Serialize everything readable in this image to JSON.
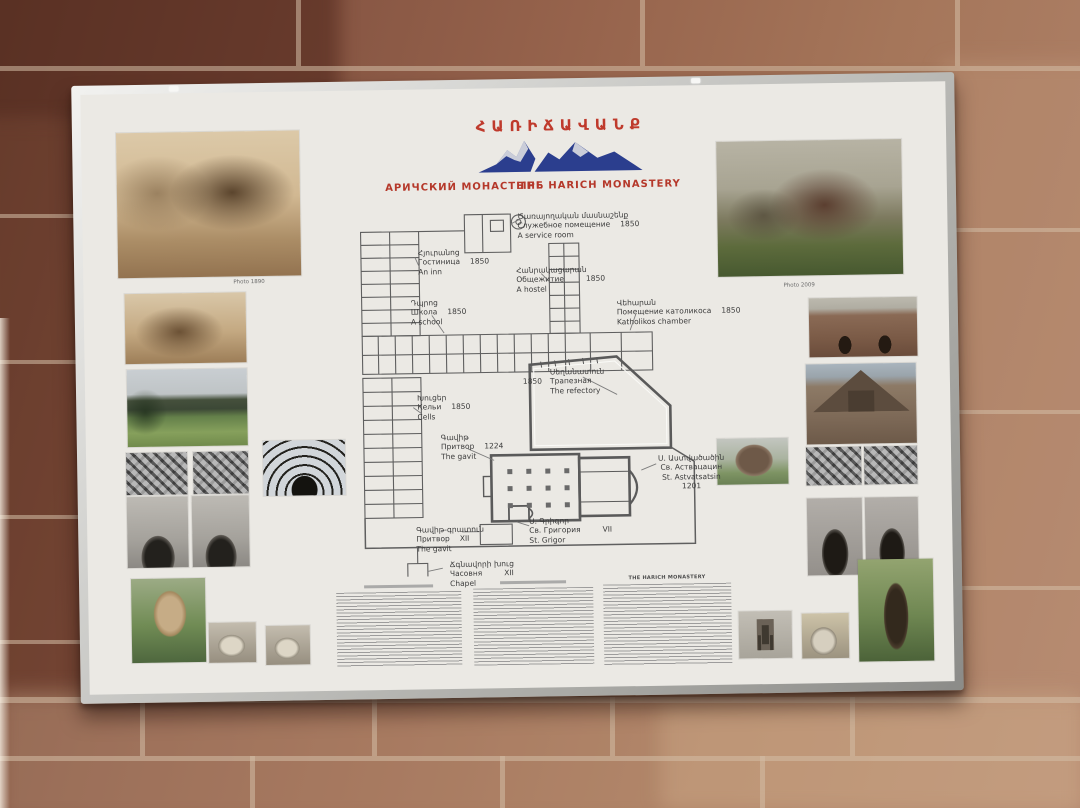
{
  "board": {
    "title_hy": "ՀԱՌԻՃԱՎԱՆՔ",
    "subtitle_ru": "АРИЧСКИЙ МОНАСТЫРЬ",
    "subtitle_en": "THE HARICH MONASTERY",
    "accent_red": "#bb3a2a",
    "mountain_blue": "#2b3e8e",
    "photo_captions": {
      "old": "Photo 1890",
      "new": "Photo 2009"
    },
    "plan": {
      "labels": [
        {
          "id": "service-room",
          "hy": "Ծառայողական մասնաշենք",
          "ru": "Служебное помещение",
          "en": "A service room",
          "year": "1850"
        },
        {
          "id": "inn",
          "hy": "Հյուրանոց",
          "ru": "Гостиница",
          "en": "An inn",
          "year": "1850"
        },
        {
          "id": "hostel",
          "hy": "Հանրակացարան",
          "ru": "Общежитие",
          "en": "A hostel",
          "year": "1850"
        },
        {
          "id": "school",
          "hy": "Դպրոց",
          "ru": "Школа",
          "en": "A school",
          "year": "1850"
        },
        {
          "id": "katholikos-chamber",
          "hy": "Վեհարան",
          "ru": "Помещение католикоса",
          "en": "Katholikos chamber",
          "year": "1850"
        },
        {
          "id": "refectory",
          "hy": "Սեղանատուն",
          "ru": "Трапезная",
          "en": "The refectory",
          "year": "1850"
        },
        {
          "id": "cells",
          "hy": "Խուցեր",
          "ru": "Кельи",
          "en": "Cells",
          "year": "1850"
        },
        {
          "id": "gavit",
          "hy": "Գավիթ",
          "ru": "Притвор",
          "en": "The gavit",
          "year": "1224"
        },
        {
          "id": "st-astvatsatsin",
          "hy": "Ս. Աստվածածին",
          "ru": "Св. Аствацацин",
          "en": "St. Astvatsatsin",
          "year": "1201"
        },
        {
          "id": "st-grigor",
          "hy": "Ս. Գրիգոր",
          "ru": "Св. Григория",
          "en": "St. Grigor",
          "year": "VII"
        },
        {
          "id": "gavit-gratun",
          "hy": "Գավիթ-գրատուն",
          "ru": "Притвор",
          "en": "The gavit",
          "year": "XII"
        },
        {
          "id": "chapel",
          "hy": "Ճգնավորի խուց",
          "ru": "Часовня",
          "en": "Chapel",
          "year": "XII"
        }
      ]
    },
    "footer": {
      "col_en_header": "THE HARICH MONASTERY"
    }
  }
}
